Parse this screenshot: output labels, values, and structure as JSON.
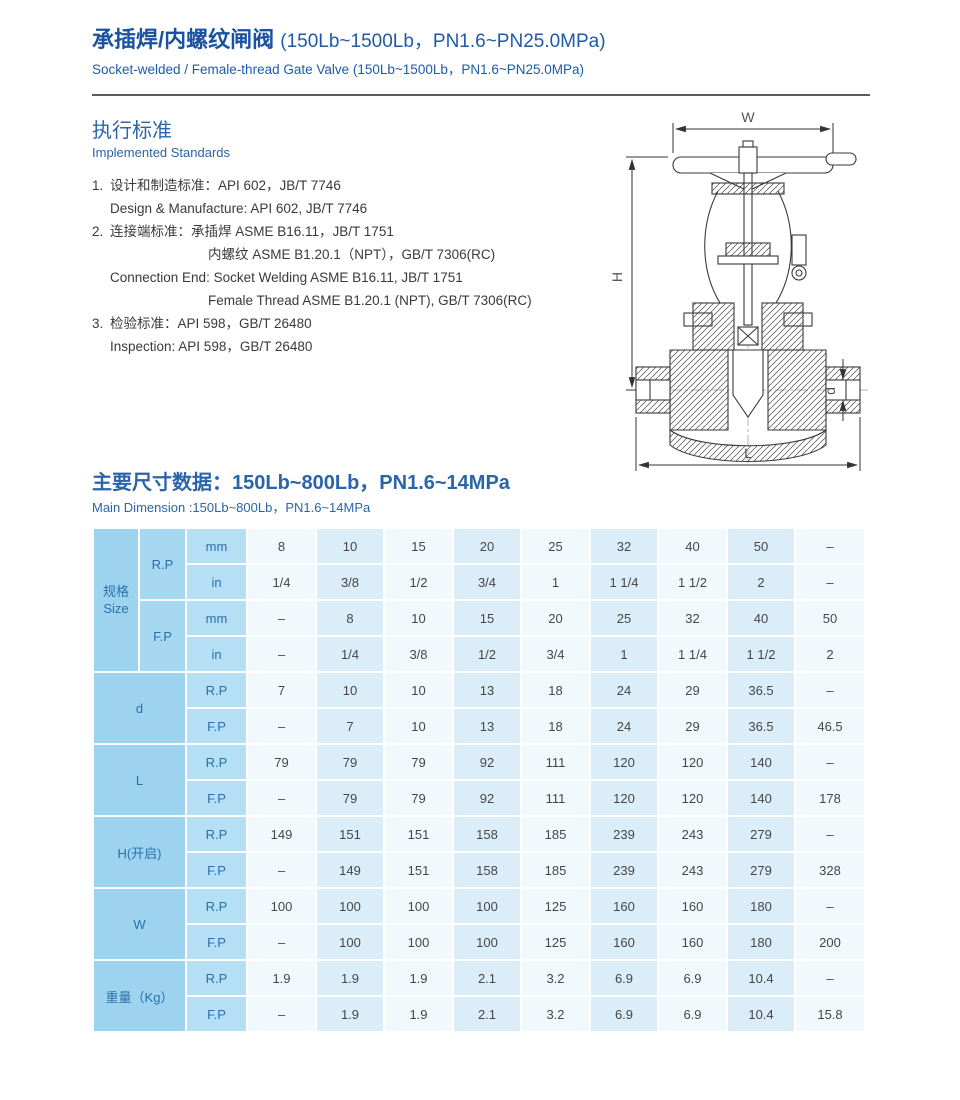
{
  "header": {
    "title_zh": "承插焊/内螺纹闸阀",
    "title_paren": "(150Lb~1500Lb，PN1.6~PN25.0MPa)",
    "subtitle_en": "Socket-welded / Female-thread Gate Valve (150Lb~1500Lb，PN1.6~PN25.0MPa)"
  },
  "standards": {
    "heading_zh": "执行标准",
    "heading_en": "Implemented Standards",
    "lines": [
      {
        "num": "1.",
        "indent": 1,
        "text": "设计和制造标准：API 602，JB/T 7746"
      },
      {
        "indent": 1,
        "text": "Design & Manufacture: API 602, JB/T 7746"
      },
      {
        "num": "2.",
        "indent": 1,
        "text": "连接端标准：承插焊  ASME B16.11，JB/T 1751"
      },
      {
        "indent": 2,
        "text": "内螺纹  ASME B1.20.1（NPT），GB/T 7306(RC)"
      },
      {
        "indent": 1,
        "text": "Connection End: Socket Welding  ASME B16.11, JB/T 1751"
      },
      {
        "indent": 2,
        "text": "Female Thread  ASME B1.20.1 (NPT), GB/T 7306(RC)"
      },
      {
        "num": "3.",
        "indent": 1,
        "text": "检验标准：API 598，GB/T 26480"
      },
      {
        "indent": 1,
        "text": "Inspection: API 598，GB/T 26480"
      }
    ]
  },
  "drawing": {
    "labels": {
      "width": "W",
      "height": "H",
      "length": "L",
      "bore": "d"
    }
  },
  "dimensions": {
    "heading_zh": "主要尺寸数据：150Lb~800Lb，PN1.6~14MPa",
    "heading_en": "Main Dimension :150Lb~800Lb，PN1.6~14MPa"
  },
  "table": {
    "size_group": {
      "label": "规格\nSize",
      "pairs": [
        {
          "label": "R.P",
          "rows": [
            {
              "unit": "mm",
              "values": [
                "8",
                "10",
                "15",
                "20",
                "25",
                "32",
                "40",
                "50",
                "–"
              ]
            },
            {
              "unit": "in",
              "values": [
                "1/4",
                "3/8",
                "1/2",
                "3/4",
                "1",
                "1 1/4",
                "1 1/2",
                "2",
                "–"
              ]
            }
          ]
        },
        {
          "label": "F.P",
          "rows": [
            {
              "unit": "mm",
              "values": [
                "–",
                "8",
                "10",
                "15",
                "20",
                "25",
                "32",
                "40",
                "50"
              ]
            },
            {
              "unit": "in",
              "values": [
                "–",
                "1/4",
                "3/8",
                "1/2",
                "3/4",
                "1",
                "1 1/4",
                "1 1/2",
                "2"
              ]
            }
          ]
        }
      ]
    },
    "groups": [
      {
        "label": "d",
        "rows": [
          {
            "unit": "R.P",
            "values": [
              "7",
              "10",
              "10",
              "13",
              "18",
              "24",
              "29",
              "36.5",
              "–"
            ]
          },
          {
            "unit": "F.P",
            "values": [
              "–",
              "7",
              "10",
              "13",
              "18",
              "24",
              "29",
              "36.5",
              "46.5"
            ]
          }
        ]
      },
      {
        "label": "L",
        "rows": [
          {
            "unit": "R.P",
            "values": [
              "79",
              "79",
              "79",
              "92",
              "111",
              "120",
              "120",
              "140",
              "–"
            ]
          },
          {
            "unit": "F.P",
            "values": [
              "–",
              "79",
              "79",
              "92",
              "111",
              "120",
              "120",
              "140",
              "178"
            ]
          }
        ]
      },
      {
        "label": "H(开启)",
        "rows": [
          {
            "unit": "R.P",
            "values": [
              "149",
              "151",
              "151",
              "158",
              "185",
              "239",
              "243",
              "279",
              "–"
            ]
          },
          {
            "unit": "F.P",
            "values": [
              "–",
              "149",
              "151",
              "158",
              "185",
              "239",
              "243",
              "279",
              "328"
            ]
          }
        ]
      },
      {
        "label": "W",
        "rows": [
          {
            "unit": "R.P",
            "values": [
              "100",
              "100",
              "100",
              "100",
              "125",
              "160",
              "160",
              "180",
              "–"
            ]
          },
          {
            "unit": "F.P",
            "values": [
              "–",
              "100",
              "100",
              "100",
              "125",
              "160",
              "160",
              "180",
              "200"
            ]
          }
        ]
      },
      {
        "label": "重量（Kg）",
        "rows": [
          {
            "unit": "R.P",
            "values": [
              "1.9",
              "1.9",
              "1.9",
              "2.1",
              "3.2",
              "6.9",
              "6.9",
              "10.4",
              "–"
            ]
          },
          {
            "unit": "F.P",
            "values": [
              "–",
              "1.9",
              "1.9",
              "2.1",
              "3.2",
              "6.9",
              "6.9",
              "10.4",
              "15.8"
            ]
          }
        ]
      }
    ]
  },
  "colors": {
    "accent_blue": "#1a52a0",
    "heading_blue": "#2a64ab",
    "table_header_bg": "#9dd3ee",
    "table_unit_bg": "#b4dff4",
    "cell_light": "#f2f9fd",
    "cell_shaded": "#dbedf8"
  }
}
